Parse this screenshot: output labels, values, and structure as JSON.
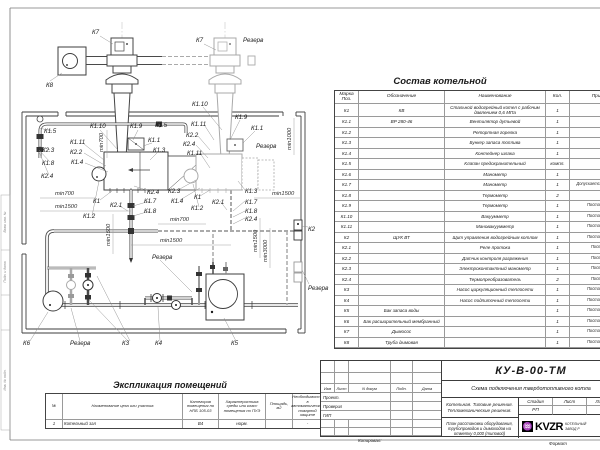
{
  "plan": {
    "labels": {
      "k1": "К1",
      "k11": "К1.1",
      "k12": "К1.2",
      "k13": "К1.3",
      "k14": "К1.4",
      "k15": "К1.5",
      "k17": "К1.7",
      "k18": "К1.8",
      "k19": "К1.9",
      "k110": "К1.10",
      "k111": "К1.11",
      "k2": "К2",
      "k21": "К2.1",
      "k22": "К2.2",
      "k23": "К2.3",
      "k24": "К2.4",
      "k3": "К3",
      "k4": "К4",
      "k5": "К5",
      "k6": "К6",
      "k7": "К7",
      "k8": "К8",
      "rezerv": "Резерв",
      "min700": "min700",
      "min1000": "min1000",
      "min1500": "min1500",
      "min3000": "min3000"
    },
    "strip": [
      "Взам. инв. №",
      "Подп. и дата",
      "Инв. № подл."
    ]
  },
  "sostav": {
    "title": "Состав котельной",
    "headers": {
      "m": "Марка Поз.",
      "o": "Обозначение",
      "n": "Наименование",
      "q": "Кол.",
      "p": "Примечание"
    },
    "rows": [
      {
        "m": "К1",
        "o": "КВ",
        "n": "Стальной водогрейный котел с рабочим давлением 0,6 МПа",
        "q": "1",
        "p": ""
      },
      {
        "m": "К1.1",
        "o": "ВР 280-46",
        "n": "Вентилятор дутьевой",
        "q": "1",
        "p": ""
      },
      {
        "m": "К1.2",
        "o": "",
        "n": "Ретортная горелка",
        "q": "1",
        "p": ""
      },
      {
        "m": "К1.3",
        "o": "",
        "n": "Бункер запаса топлива",
        "q": "1",
        "p": ""
      },
      {
        "m": "К1.4",
        "o": "",
        "n": "Контейнер шлака",
        "q": "1",
        "p": ""
      },
      {
        "m": "К1.5",
        "o": "",
        "n": "Клапан предохранительный",
        "q": "компл.",
        "p": ""
      },
      {
        "m": "К1.6",
        "o": "",
        "n": "Манометр",
        "q": "1",
        "p": ""
      },
      {
        "m": "К1.7",
        "o": "",
        "n": "Манометр",
        "q": "1",
        "p": "Допускается замена поз. К2.3"
      },
      {
        "m": "К1.8",
        "o": "",
        "n": "Термометр",
        "q": "2",
        "p": ""
      },
      {
        "m": "К1.9",
        "o": "",
        "n": "Термометр",
        "q": "1",
        "p": "Постав. по соглас."
      },
      {
        "m": "К1.10",
        "o": "",
        "n": "Вакуумметр",
        "q": "1",
        "p": "Постав. по соглас."
      },
      {
        "m": "К1.11",
        "o": "",
        "n": "Мановакуумметр",
        "q": "1",
        "p": "Постав. по соглас."
      },
      {
        "m": "К2",
        "o": "ЩУК ВТ",
        "n": "Щит управления водогрейным котлом",
        "q": "1",
        "p": "Постав. по соглас."
      },
      {
        "m": "К2.1",
        "o": "",
        "n": "Реле протока",
        "q": "1",
        "p": "Постав. с ЩУК"
      },
      {
        "m": "К2.2",
        "o": "",
        "n": "Датчик контроля разряжения",
        "q": "1",
        "p": "Постав. с ЩУК"
      },
      {
        "m": "К2.3",
        "o": "",
        "n": "Электроконтактный манометр",
        "q": "1",
        "p": "Постав. с ЩУК"
      },
      {
        "m": "К2.4",
        "o": "",
        "n": "Термопреобразователь",
        "q": "2",
        "p": "Постав. с ЩУК"
      },
      {
        "m": "К3",
        "o": "",
        "n": "Насос циркуляционный теплосети",
        "q": "1",
        "p": "Постав. по соглас."
      },
      {
        "m": "К4",
        "o": "",
        "n": "Насос подпиточный теплосети",
        "q": "1",
        "p": "Постав. по соглас."
      },
      {
        "m": "К5",
        "o": "Бак запаса воды",
        "n": "",
        "q": "1",
        "p": "Постав. по соглас."
      },
      {
        "m": "К6",
        "o": "Бак расширительный мембранный",
        "n": "",
        "q": "1",
        "p": "Постав. по соглас."
      },
      {
        "m": "К7",
        "o": "Дымосос",
        "n": "",
        "q": "1",
        "p": "Постав. по соглас."
      },
      {
        "m": "К8",
        "o": "Труба дымовая",
        "n": "",
        "q": "1",
        "p": "Постав. по соглас."
      }
    ]
  },
  "explication": {
    "title": "Экспликация помещений",
    "headers": [
      "№",
      "Наименование цеха или участка",
      "Категория помещения по НПБ 105-03",
      "Характеристика среды или класс помещения по ПУЭ",
      "Площадь, м2",
      "Необходимость в автоматической пожарной защите",
      "Приме- чание"
    ],
    "row": [
      "1",
      "Котельный зал",
      "В4",
      "норм.",
      "",
      "-",
      ""
    ]
  },
  "titleblock": {
    "code": "КУ-В-00-ТМ",
    "subtitle": "Схема подключения твердотопливного котла",
    "rev_cols": [
      "Изм",
      "Лист",
      "N докум",
      "Подп.",
      "Дата"
    ],
    "roles": [
      "Проект.",
      "Проверил",
      "ГИП"
    ],
    "project_line1": "Котельная. Типовые решения.",
    "project_line2": "Тепломеханические решения.",
    "sheet_name": "План расстановки оборудования, трубопроводов и дымоходов на отметку 0,000 (типовой)",
    "stage_label": "Стадия",
    "sheet_label": "Лист",
    "sheets_label": "Листов",
    "stage": "РП",
    "sheet_num": "-",
    "sheets_num": "-",
    "logo": "KVZR",
    "logo_glyph": "♒",
    "company_line1": "КОТЕЛЬНЫЙ",
    "company_line2": "ЗАВОД Р",
    "copied": "Копировал:",
    "format": "Формат"
  }
}
